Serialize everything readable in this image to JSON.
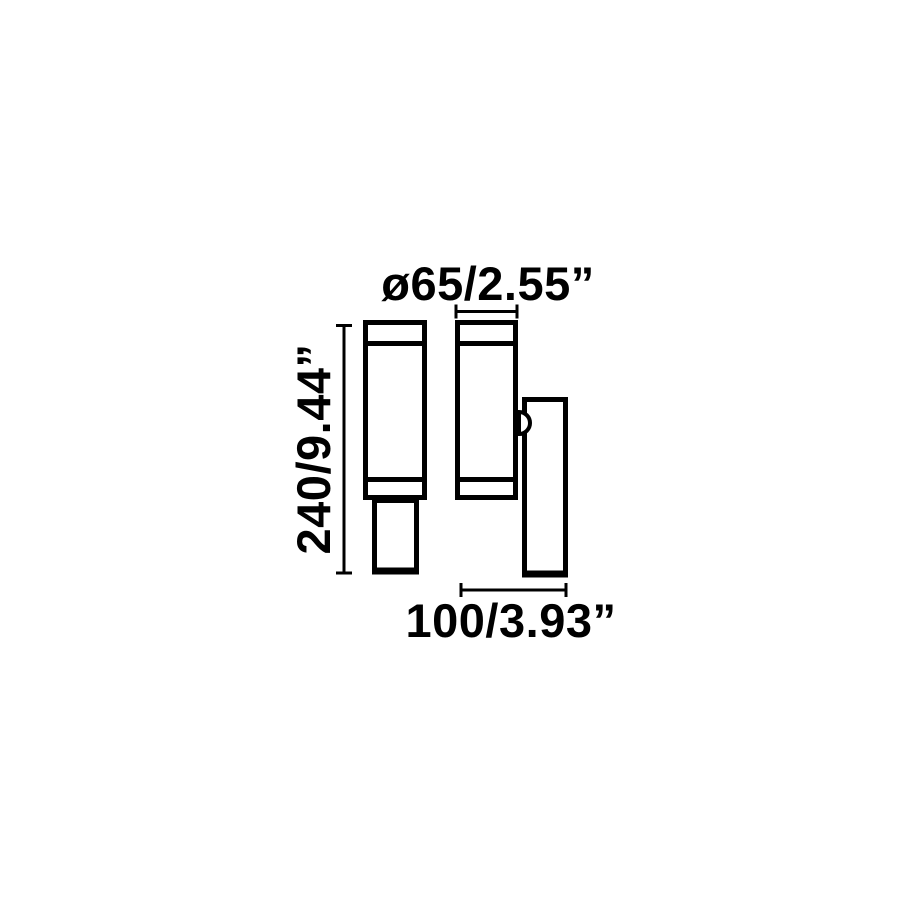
{
  "page": {
    "background_color": "#ffffff",
    "line_color": "#000000"
  },
  "drawing": {
    "labels": {
      "diameter": "ø65/2.55”",
      "height": "240/9.44”",
      "depth": "100/3.93”"
    }
  }
}
